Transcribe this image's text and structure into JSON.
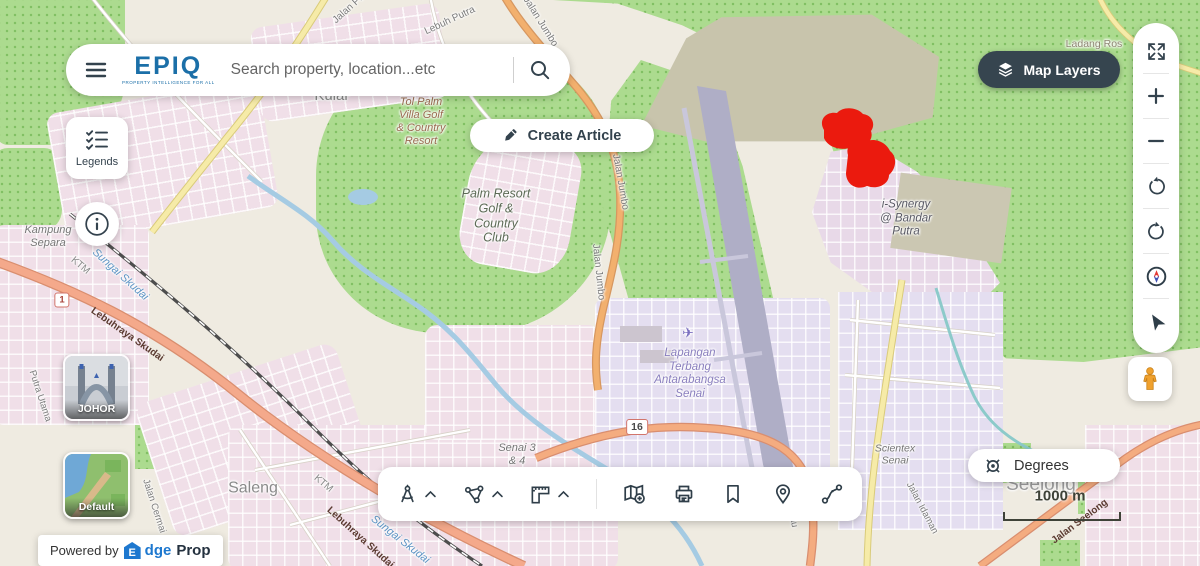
{
  "header": {
    "logo_text": "EPIQ",
    "logo_tagline": "PROPERTY INTELLIGENCE FOR ALL",
    "search_placeholder": "Search property, location...etc",
    "create_article_label": "Create Article",
    "map_layers_label": "Map Layers"
  },
  "side": {
    "legends_label": "Legends"
  },
  "basemap_switcher": {
    "johor_label": "JOHOR",
    "default_label": "Default"
  },
  "attribution": {
    "powered_by": "Powered by",
    "brand_e": "E",
    "brand_mid": "dge",
    "brand_end": "Prop"
  },
  "controls": {
    "degrees_label": "Degrees",
    "scale_label": "1000 m"
  },
  "shields": {
    "route_1": "1",
    "route_16": "16"
  },
  "icons": {
    "airplane": "✈"
  },
  "labels": {
    "palm_resort": "Palm Resort\nGolf &\nCountry\nClub",
    "tol_palm": "Tol Palm\nVilla Golf\n& Country\nResort",
    "i_synergy": "i-Synergy\n@ Bandar\nPutra",
    "airport": "Lapangan\nTerbang\nAntarabangsa\nSenai",
    "senai_34": "Senai 3\n& 4",
    "saleng": "Saleng",
    "seelong": "Seelong",
    "scientex": "Scientex\nSenai",
    "kampung_separa": "Kampung\nSepara",
    "kulai": "Kulai",
    "ladang_ros": "Ladang Ros",
    "sungai_skudai_a": "Sungai Skudai",
    "sungai_skudai_b": "Sungai Skudai",
    "ktm_a": "KTM",
    "ktm_b": "KTM",
    "lebuhraya_skudai_a": "Lebuhraya Skudai",
    "lebuhraya_skudai_b": "Lebuhraya Skudai",
    "jalan_jumbo_a": "Jalan Jumbo",
    "jalan_jumbo_b": "Jalan Jumbo",
    "jalan_jumbo_c": "Jalan Jumbo",
    "lebuh_putra": "Lebuh Putra",
    "lebuh_putra_utama": "Lebuh Putra Utama",
    "jalan_pu": "Jalan Pu",
    "putra_utama": "Putra Utama",
    "jalan_cermai": "Jalan Cermai",
    "jalan_idaman": "Jalan Idaman",
    "jalan_seelong": "Jalan Seelong",
    "tebrau": "Tebrau"
  },
  "colors": {
    "epiq_blue": "#1B6FA8",
    "dark_slate": "#33424D",
    "map_layers_bg": "#36454F",
    "whatsapp_green": "#25D366",
    "highlight_red": "#EB1A0E",
    "edgeprop_blue": "#1E78CF"
  }
}
